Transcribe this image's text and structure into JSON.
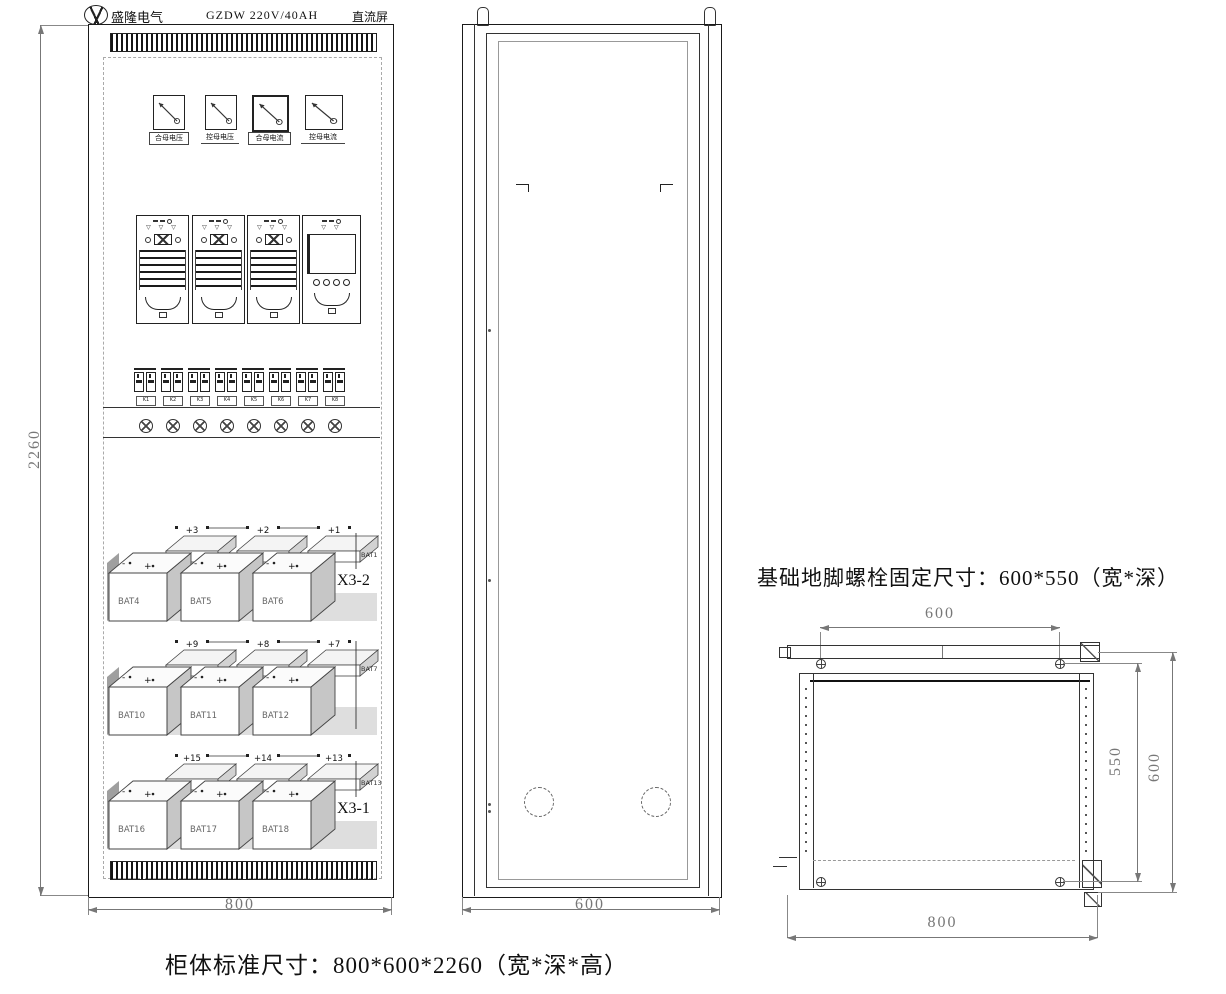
{
  "title_block": {
    "logo_text": "盛隆电气",
    "model": "GZDW 220V/40AH",
    "product": "直流屏"
  },
  "front_view": {
    "meters": [
      {
        "label": "合母电压"
      },
      {
        "label": "控母电压"
      },
      {
        "label": "合母电流"
      },
      {
        "label": "控母电流"
      }
    ],
    "modules": [
      {
        "type": "rectifier"
      },
      {
        "type": "rectifier"
      },
      {
        "type": "rectifier"
      },
      {
        "type": "monitor"
      }
    ],
    "module_indicator_symbol": "▽",
    "polarity": [
      "-",
      "+"
    ],
    "breakers": [
      "K1",
      "K2",
      "K3",
      "K4",
      "K5",
      "K6",
      "K7",
      "K8"
    ],
    "battery_rows": [
      {
        "tag": "X3-2",
        "back": [
          {
            "terminal": "+3",
            "name": "BAT3"
          },
          {
            "terminal": "+2",
            "name": "BAT2"
          },
          {
            "terminal": "+1",
            "name": "BAT1"
          }
        ],
        "front": [
          "BAT4",
          "BAT5",
          "BAT6"
        ]
      },
      {
        "tag": "",
        "back": [
          {
            "terminal": "+9",
            "name": "BAT9"
          },
          {
            "terminal": "+8",
            "name": "BAT8"
          },
          {
            "terminal": "+7",
            "name": "BAT7"
          }
        ],
        "front": [
          "BAT10",
          "BAT11",
          "BAT12"
        ]
      },
      {
        "tag": "X3-1",
        "back": [
          {
            "terminal": "+15",
            "name": "BAT15"
          },
          {
            "terminal": "+14",
            "name": "BAT14"
          },
          {
            "terminal": "+13",
            "name": "BAT13"
          }
        ],
        "front": [
          "BAT16",
          "BAT17",
          "BAT18"
        ]
      }
    ],
    "dim_width": "800",
    "dim_height": "2260"
  },
  "side_view": {
    "dim_depth": "600"
  },
  "plan_view": {
    "note": "基础地脚螺栓固定尺寸：600*550（宽*深）",
    "dim_bolt_width": "600",
    "dim_bolt_depth": "550",
    "dim_depth": "600",
    "dim_width": "800"
  },
  "caption": "柜体标准尺寸：800*600*2260（宽*深*高）"
}
